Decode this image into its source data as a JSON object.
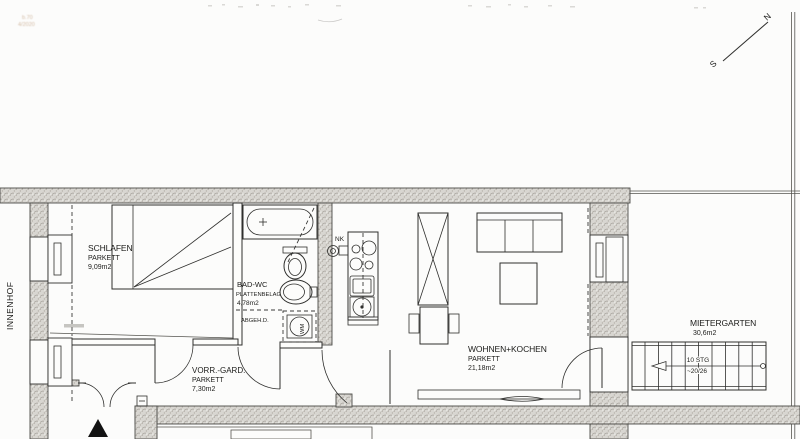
{
  "document_type": "apartment floor plan (scanned)",
  "stamp": {
    "line1": "b.70",
    "line2": "4/2020"
  },
  "compass": {
    "north": "N",
    "south": "S"
  },
  "outside": {
    "innenhof": "INNENHOF",
    "mietergarten": {
      "name": "MIETERGARTEN",
      "area": "30,6m2"
    }
  },
  "rooms": {
    "schlafen": {
      "name": "SCHLAFEN",
      "floor": "PARKETT",
      "area": "9,09m2"
    },
    "bad": {
      "name": "BAD-WC",
      "floor": "PLATTENBELAG",
      "area": "4,78m2",
      "note": "ABGEH.D."
    },
    "vorraum": {
      "name": "VORR.-GARD.",
      "floor": "PARKETT",
      "area": "7,30m2"
    },
    "wohnen": {
      "name": "WOHNEN+KOCHEN",
      "floor": "PARKETT",
      "area": "21,18m2"
    }
  },
  "kitchen": {
    "nk_label": "NK"
  },
  "laundry": {
    "wm_label": "WM"
  },
  "stairs": {
    "steps_label": "10 STG",
    "dimension_label": "~20/26"
  },
  "colors": {
    "paper": "#fcfcfb",
    "wall_fill": "#d8d6d1",
    "line": "#2f2f2d",
    "stamp": "#b0855c"
  }
}
